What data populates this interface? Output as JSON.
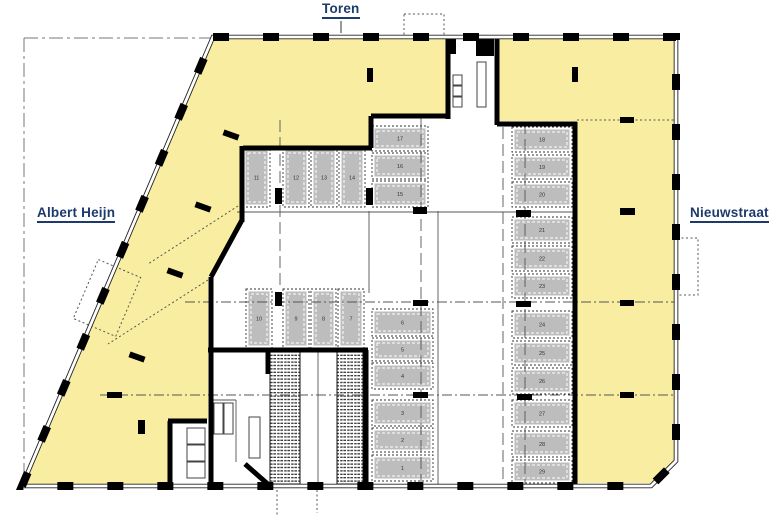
{
  "page": {
    "type": "architectural floor plan (parking level)",
    "background": "#ffffff"
  },
  "labels": {
    "toren": "Toren",
    "albert_heijn": "Albert Heijn",
    "nieuwstraat": "Nieuwstraat"
  },
  "colors": {
    "zone_yellow": "#F8EDA1",
    "stall_gray": "#BDBDBD",
    "label_navy": "#1D3A6D",
    "wall_black": "#000000"
  },
  "parking": {
    "total_stalls": 29,
    "groups": [
      {
        "id": "top-row",
        "stalls": [
          "11",
          "12",
          "13",
          "14"
        ]
      },
      {
        "id": "upper-left-column",
        "stalls": [
          "17",
          "16",
          "15"
        ]
      },
      {
        "id": "middle-row",
        "stalls": [
          "10",
          "9",
          "8",
          "7"
        ]
      },
      {
        "id": "lower-left-column",
        "stalls": [
          "6",
          "5",
          "4",
          "3",
          "2",
          "1"
        ]
      },
      {
        "id": "right-column",
        "stalls": [
          "18",
          "19",
          "20",
          "21",
          "22",
          "23",
          "24",
          "25",
          "26",
          "27",
          "28",
          "29"
        ]
      }
    ]
  }
}
